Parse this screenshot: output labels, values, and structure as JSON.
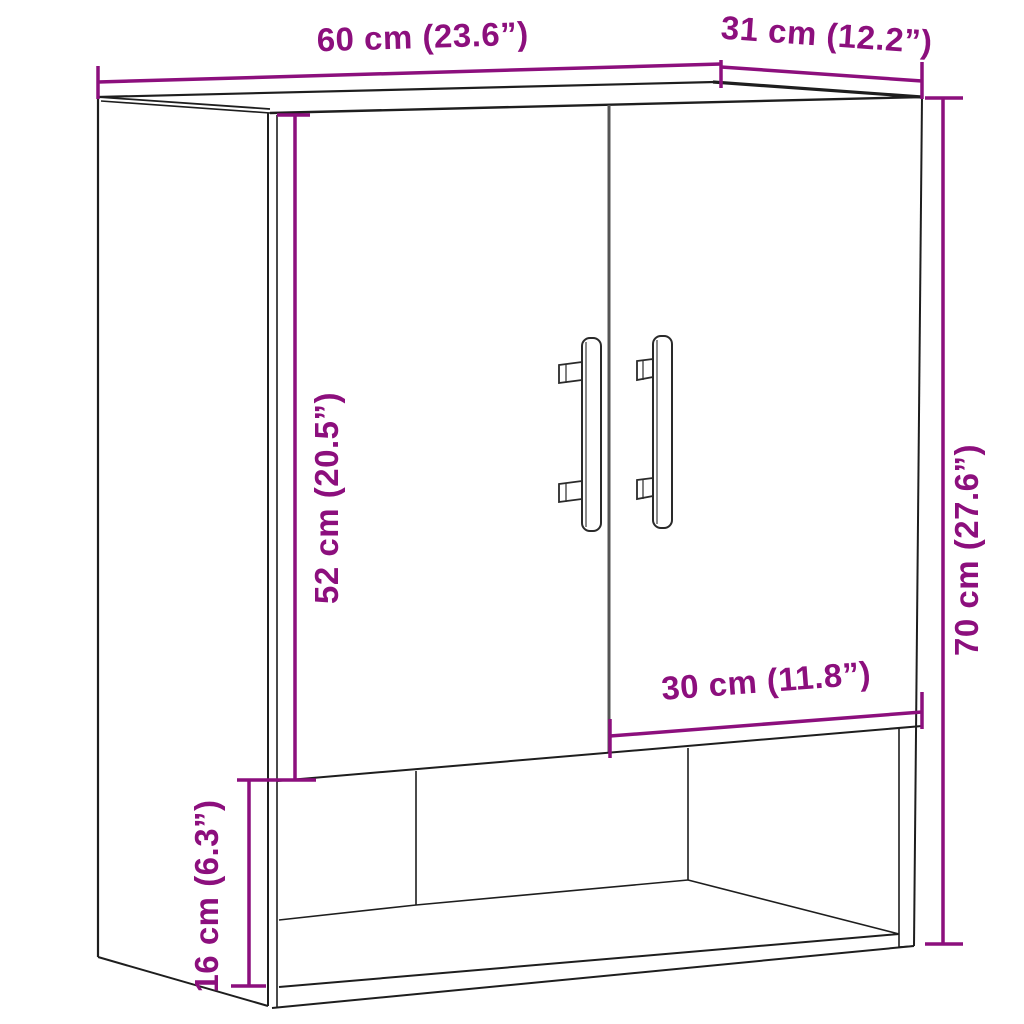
{
  "page": {
    "background": "#ffffff",
    "description": "Wall cabinet product dimension diagram: two-door cabinet with open bottom shelf, shown in perspective line drawing"
  },
  "colors": {
    "dimension_accent": "#8C0F7D",
    "cabinet_outline": "#1e1e1e",
    "door_gap": "#555555"
  },
  "dimensions": {
    "width": "60 cm (23.6”)",
    "depth": "31 cm (12.2”)",
    "door_height": "52 cm (20.5”)",
    "height": "70 cm (27.6”)",
    "door_width": "30 cm (11.8”)",
    "open_shelf_height": "16 cm (6.3”)"
  }
}
